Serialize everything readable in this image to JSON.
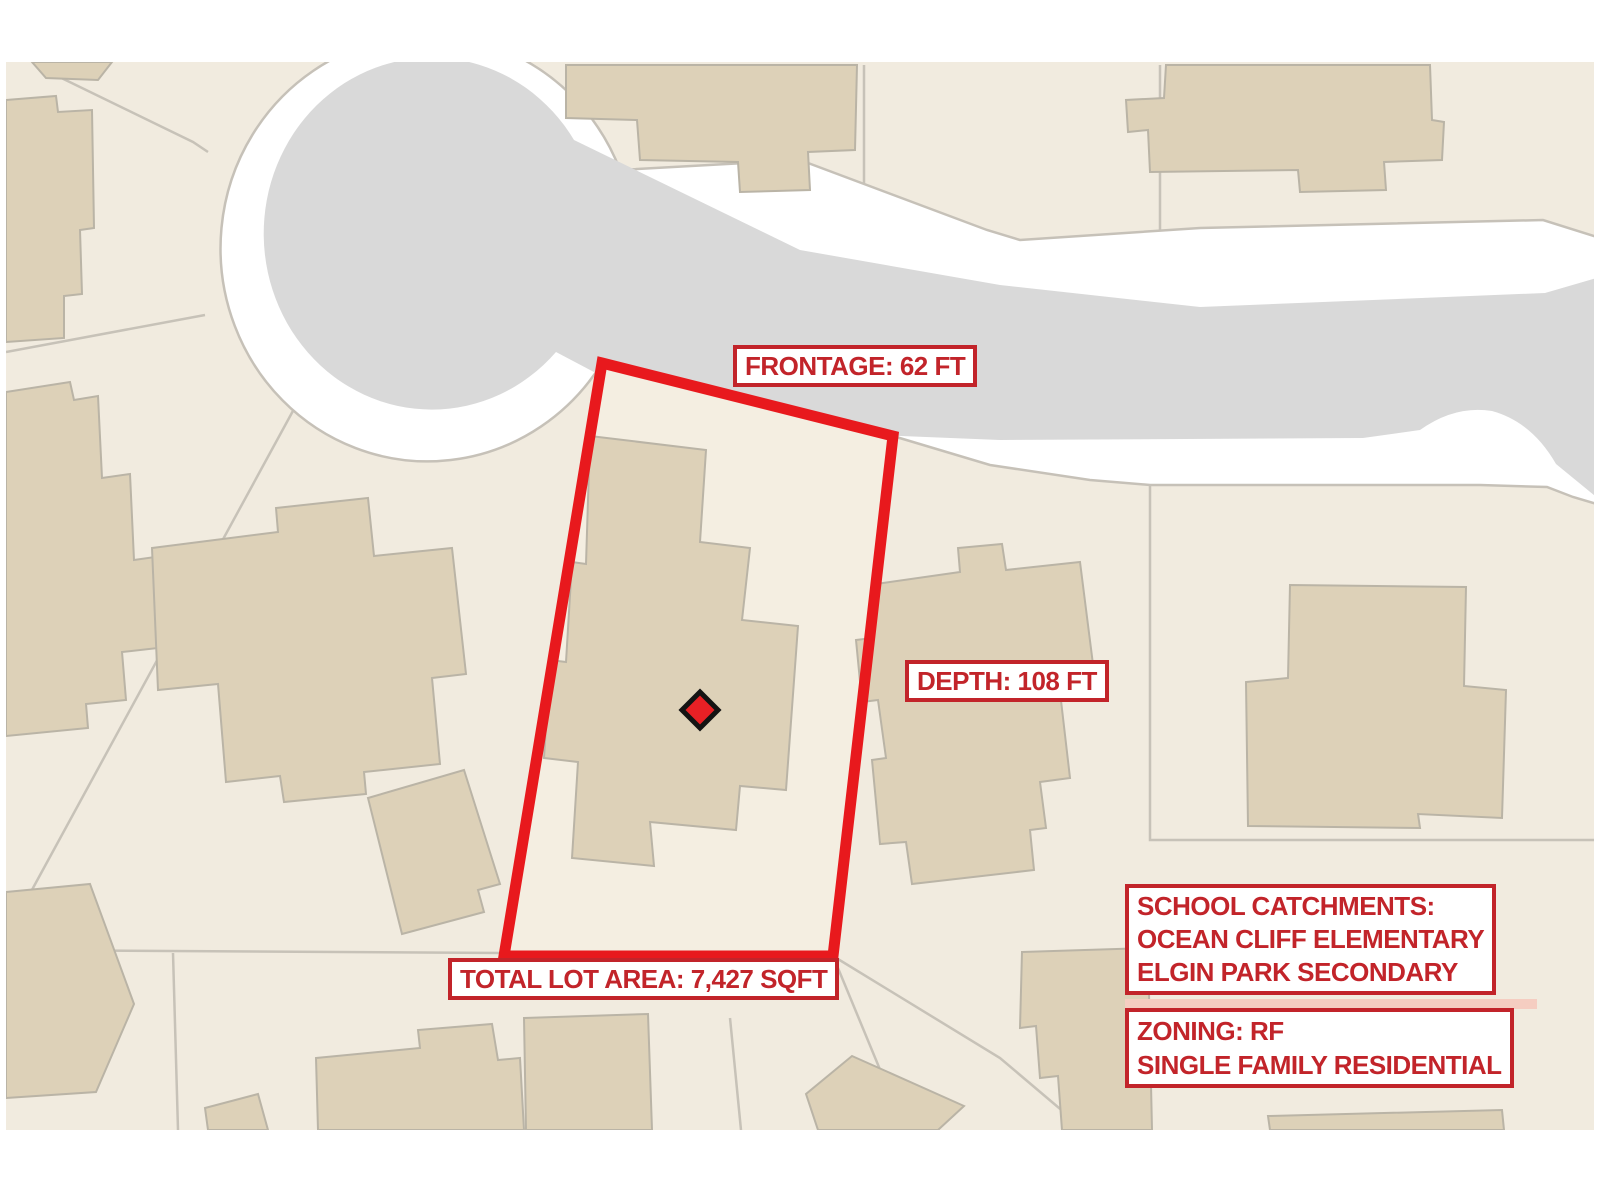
{
  "map": {
    "annotations": {
      "frontage": "FRONTAGE: 62 FT",
      "depth": "DEPTH: 108 FT",
      "total_lot_area": "TOTAL LOT AREA: 7,427 SQFT",
      "school_catchments": {
        "heading": "SCHOOL CATCHMENTS:",
        "elementary": "OCEAN CLIFF ELEMENTARY",
        "secondary": "ELGIN PARK SECONDARY"
      },
      "zoning": {
        "code": "ZONING: RF",
        "description": "SINGLE FAMILY RESIDENTIAL"
      }
    },
    "subject_lot": {
      "frontage_ft": "62 FT",
      "depth_ft": "108 FT",
      "total_lot_area_sqft": "7,427 SQFT",
      "marker": "red-diamond"
    },
    "colors": {
      "annotation_red": "#c2242a",
      "lot_outline_red": "#e8191d",
      "marker_red": "#e82025",
      "road_gray": "#d9d9d9",
      "right_of_way_white": "#ffffff",
      "parcel_cream": "#f1ebdf",
      "building_tan": "#ddd1b8",
      "boundary_gray": "#c7c2b8"
    }
  }
}
